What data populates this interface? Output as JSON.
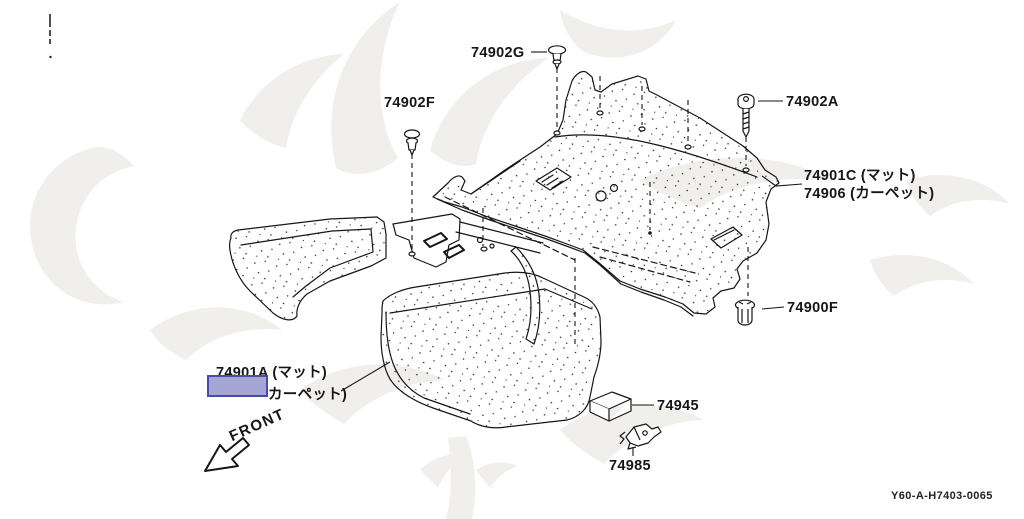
{
  "diagram": {
    "drawing_code": "Y60-A-H7403-0065",
    "front_indicator": "FRONT",
    "highlight_color": "#a6a6d6",
    "callouts": [
      {
        "id": "74902G",
        "label": "74902G",
        "icon": "push-clip-icon"
      },
      {
        "id": "74902F",
        "label": "74902F",
        "icon": "push-clip-icon"
      },
      {
        "id": "74902A",
        "label": "74902A",
        "icon": "screw-icon"
      },
      {
        "id": "74901C",
        "label": "74901C (マット)",
        "icon": "rear-floor-mat"
      },
      {
        "id": "74906",
        "label": "74906 (カーペット)",
        "icon": "rear-floor-mat"
      },
      {
        "id": "74900F",
        "label": "74900F",
        "icon": "grommet-icon"
      },
      {
        "id": "74901A",
        "label": "74901A (マット)",
        "icon": "front-floor-mat"
      },
      {
        "id": "74901A-carpet",
        "label": "カーペット)",
        "icon": "front-floor-mat"
      },
      {
        "id": "74945",
        "label": "74945",
        "icon": "pad-icon"
      },
      {
        "id": "74985",
        "label": "74985",
        "icon": "hook-clip-icon"
      }
    ]
  }
}
